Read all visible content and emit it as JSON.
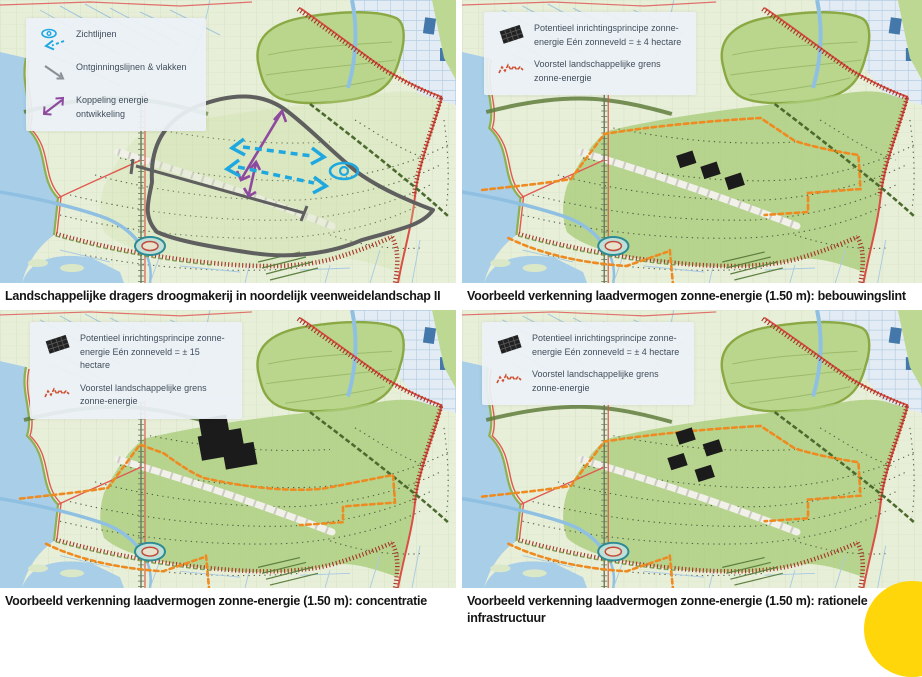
{
  "panels": [
    {
      "id": "landschappelijke-dragers",
      "caption": "Landschappelijke dragers droogmakerij in noordelijk veenweidelandschap II",
      "legend": {
        "items": [
          {
            "icon": "sightlines-icon",
            "label": "Zichtlijnen"
          },
          {
            "icon": "reclamation-lines-icon",
            "label": "Ontginningslijnen & vlakken"
          },
          {
            "icon": "energy-coupling-icon",
            "label": "Koppeling energie ontwikkeling"
          }
        ]
      }
    },
    {
      "id": "bebouwingslint",
      "caption": "Voorbeeld verkenning laadvermogen zonne-energie (1.50 m): bebouwingslint",
      "legend": {
        "items": [
          {
            "icon": "solar-panel-icon",
            "label": "Potentieel inrichtingsprincipe zonne-energie Eén zonneveld = ± 4 hectare"
          },
          {
            "icon": "boundary-squiggle-icon",
            "label": "Voorstel landschappelijke grens zonne-energie"
          }
        ]
      }
    },
    {
      "id": "concentratie",
      "caption": "Voorbeeld verkenning laadvermogen zonne-energie (1.50 m): concentratie",
      "legend": {
        "items": [
          {
            "icon": "solar-panel-icon",
            "label": "Potentieel inrichtingsprincipe zonne-energie Eén zonneveld = ± 15 hectare"
          },
          {
            "icon": "boundary-squiggle-icon",
            "label": "Voorstel landschappelijke grens zonne-energie"
          }
        ]
      }
    },
    {
      "id": "rationele-infrastructuur",
      "caption": "Voorbeeld verkenning laadvermogen zonne-energie (1.50 m): rationele infrastructuur",
      "legend": {
        "items": [
          {
            "icon": "solar-panel-icon",
            "label": "Potentieel inrichtingsprincipe zonne-energie Eén zonneveld = ± 4 hectare"
          },
          {
            "icon": "boundary-squiggle-icon",
            "label": "Voorstel landschappelijke grens zonne-energie"
          }
        ]
      }
    }
  ],
  "colors": {
    "sightline_blue": "#1fa8e0",
    "coupling_purple": "#8d4a9e",
    "reclamation_gray": "#8a9096",
    "solar_black": "#1b1b1b",
    "boundary_orange": "#ee8a20",
    "squiggle_red": "#cf4f30",
    "map_green": "#b9d68c",
    "water_blue": "#a9cee8",
    "decoration_yellow": "#ffd60a"
  },
  "page_decoration": {
    "shape": "circle",
    "color": "#ffd60a",
    "position": "bottom-right"
  }
}
